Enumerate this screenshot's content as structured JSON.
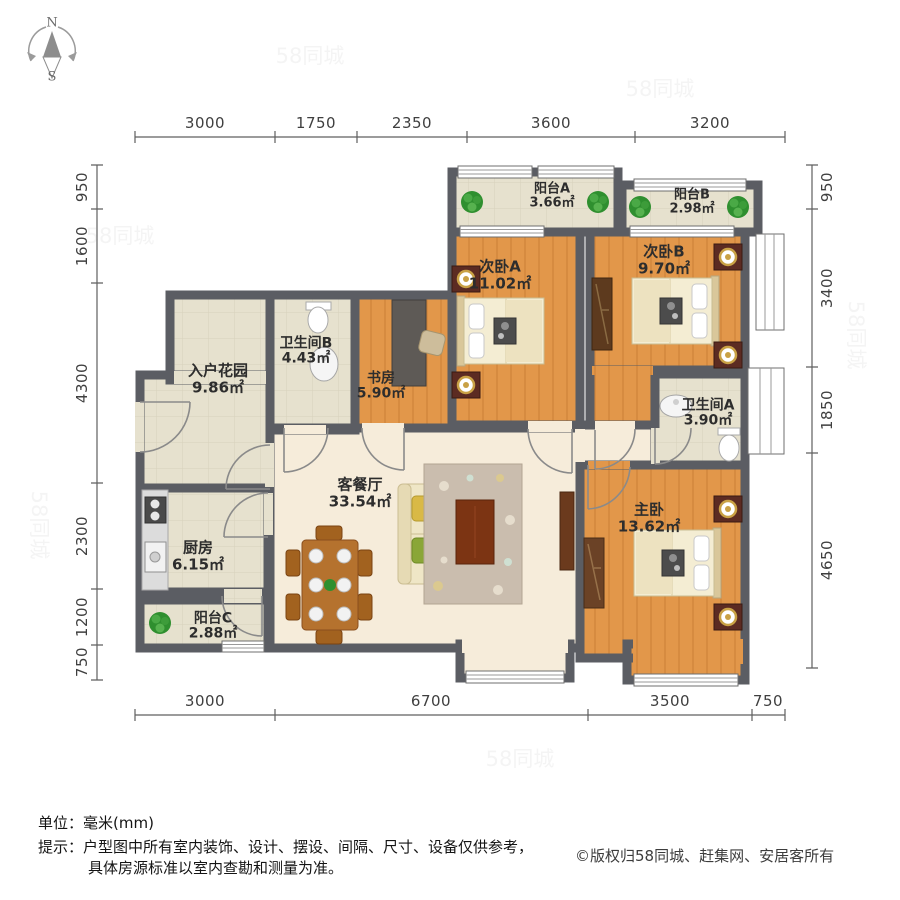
{
  "compass": {
    "n": "N",
    "s": "S"
  },
  "dims": {
    "top": [
      "3000",
      "1750",
      "2350",
      "3600",
      "3200"
    ],
    "bottom": [
      "3000",
      "6700",
      "3500",
      "750"
    ],
    "left": [
      "950",
      "1600",
      "4300",
      "2300",
      "1200",
      "750"
    ],
    "right": [
      "950",
      "3400",
      "1850",
      "4650"
    ]
  },
  "rooms": {
    "balconyA": {
      "name": "阳台A",
      "area": "3.66㎡"
    },
    "balconyB": {
      "name": "阳台B",
      "area": "2.98㎡"
    },
    "bedroomA": {
      "name": "次卧A",
      "area": "11.02㎡"
    },
    "bedroomB": {
      "name": "次卧B",
      "area": "9.70㎡"
    },
    "bathroomB": {
      "name": "卫生间B",
      "area": "4.43㎡"
    },
    "study": {
      "name": "书房",
      "area": "5.90㎡"
    },
    "entryGarden": {
      "name": "入户花园",
      "area": "9.86㎡"
    },
    "bathroomA": {
      "name": "卫生间A",
      "area": "3.90㎡"
    },
    "living": {
      "name": "客餐厅",
      "area": "33.54㎡"
    },
    "kitchen": {
      "name": "厨房",
      "area": "6.15㎡"
    },
    "balconyC": {
      "name": "阳台C",
      "area": "2.88㎡"
    },
    "master": {
      "name": "主卧",
      "area": "13.62㎡"
    }
  },
  "footer": {
    "unit": "单位：毫米(mm)",
    "tip1": "提示：户型图中所有室内装饰、设计、摆设、间隔、尺寸、设备仅供参考，",
    "tip2": "具体房源标准以室内查勘和测量为准。",
    "copyright": "©版权归58同城、赶集网、安居客所有"
  },
  "watermark": {
    "text": "58同城"
  },
  "colors": {
    "wall": "#5b5d63",
    "wood_floor": "#e2974a",
    "tile_floor": "#e6e1ce",
    "living_floor": "#f6ecda",
    "plant": "#2f8f2f"
  }
}
